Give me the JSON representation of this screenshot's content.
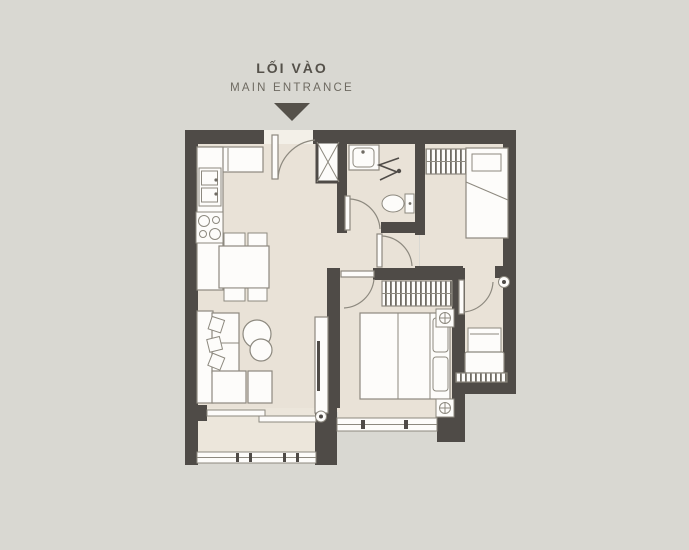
{
  "title": {
    "vi": "LỐI VÀO",
    "en": "MAIN ENTRANCE"
  },
  "entrance_arrow_icon": "down-triangle",
  "colors": {
    "bg": "#d9d8d2",
    "floor": "#e9e2d7",
    "balcony": "#ece6db",
    "wall": "#4f4b47",
    "furn": "#fdfcfa",
    "line": "#8d897f",
    "hatch": "#6f6b63",
    "text_dark": "#55514a",
    "text_light": "#6e6a61",
    "threshold": "#f3f0e8"
  },
  "plan_elements": [
    "main-entrance-door",
    "technical-shaft",
    "kitchen-counter",
    "kitchen-sink",
    "cooktop",
    "dining-table",
    "dining-chairs",
    "l-shaped-sofa",
    "coffee-tables",
    "tv-cabinet",
    "sliding-balcony-door",
    "balcony-railing",
    "master-double-bed",
    "nightstands",
    "master-wardrobe",
    "master-window",
    "bathroom-sink",
    "toilet",
    "shower-partition",
    "bedroom2-wardrobe",
    "single-bed",
    "armchair",
    "ac-louver-ledge",
    "fixture-marker"
  ]
}
